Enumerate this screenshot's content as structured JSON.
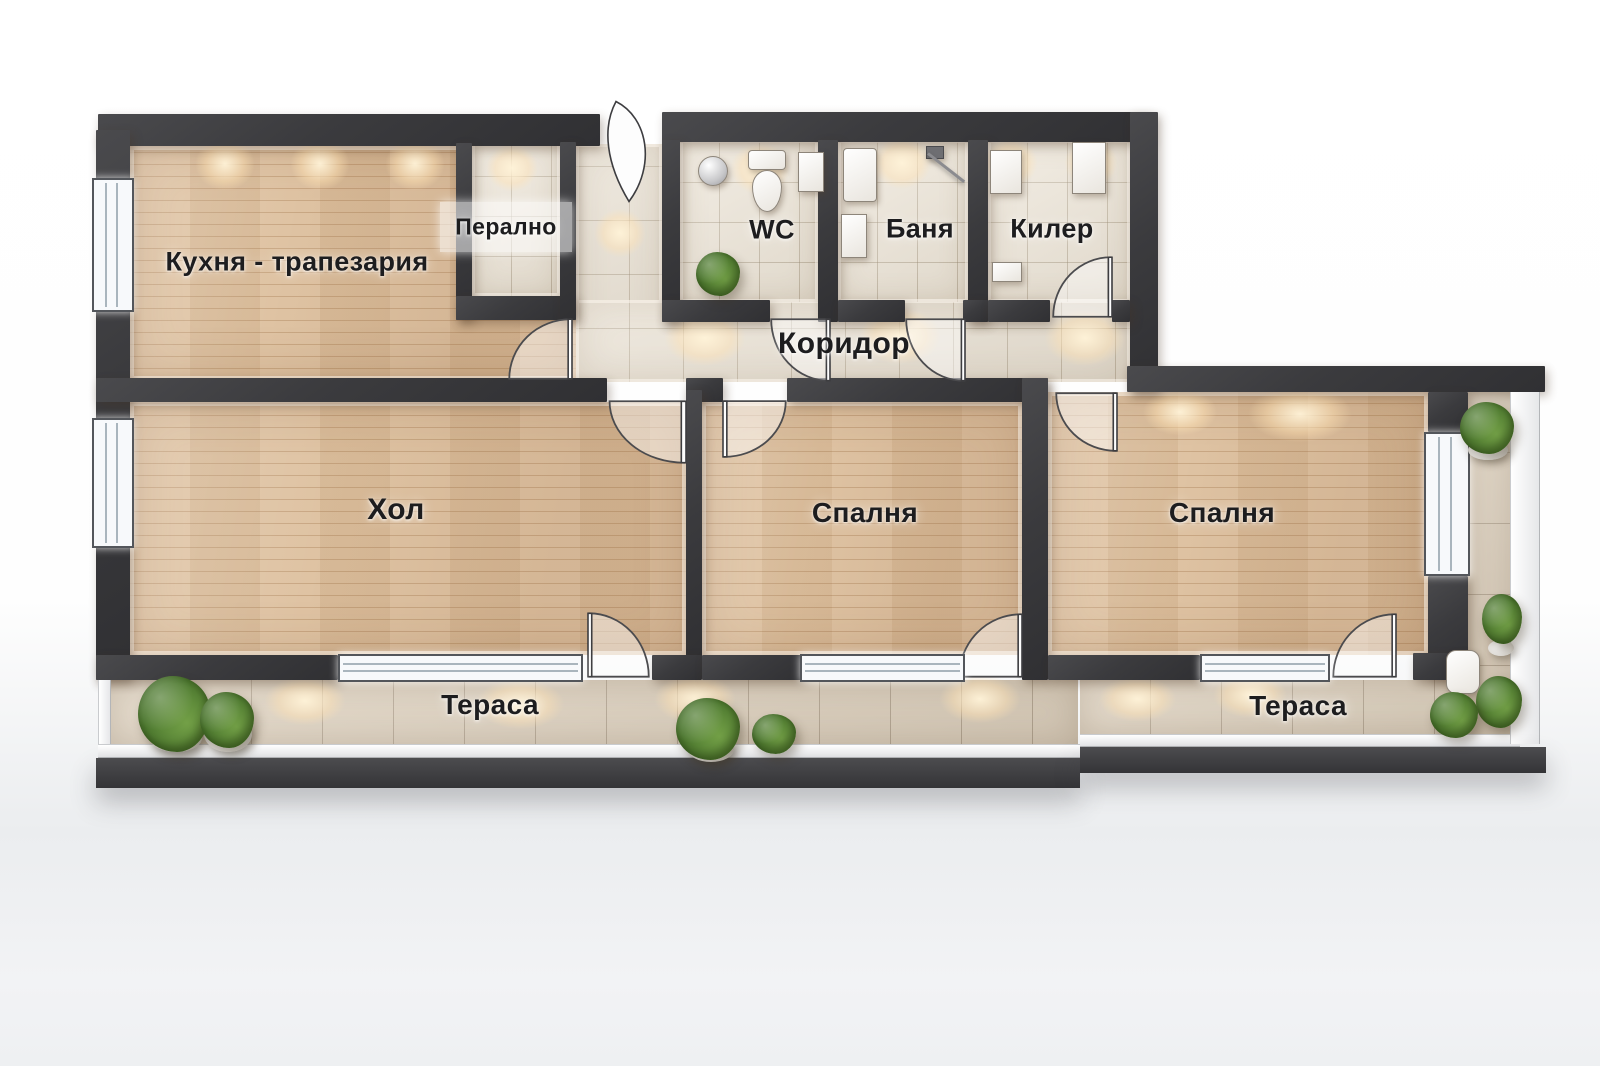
{
  "plan": {
    "rooms": [
      {
        "id": "kitchen-dining",
        "label": "Кухня - трапезария"
      },
      {
        "id": "laundry",
        "label": "Перално"
      },
      {
        "id": "wc",
        "label": "WC"
      },
      {
        "id": "bathroom",
        "label": "Баня"
      },
      {
        "id": "storage",
        "label": "Килер"
      },
      {
        "id": "corridor",
        "label": "Коридор"
      },
      {
        "id": "living-room",
        "label": "Хол"
      },
      {
        "id": "bedroom-1",
        "label": "Спалня"
      },
      {
        "id": "bedroom-2",
        "label": "Спалня"
      },
      {
        "id": "terrace-left",
        "label": "Тераса"
      },
      {
        "id": "terrace-right",
        "label": "Тераса"
      }
    ],
    "colors": {
      "wall": "#3b3b3e",
      "wood_floor": "#ddc09e",
      "tile_floor": "#e9e1d3",
      "terrace_tile": "#dccfbc",
      "label_text": "#1d1d1f",
      "plant_green": "#4e7a30",
      "window_frame": "#53565b",
      "page_background": "#ffffff",
      "page_background_lower": "#edeff1"
    }
  }
}
